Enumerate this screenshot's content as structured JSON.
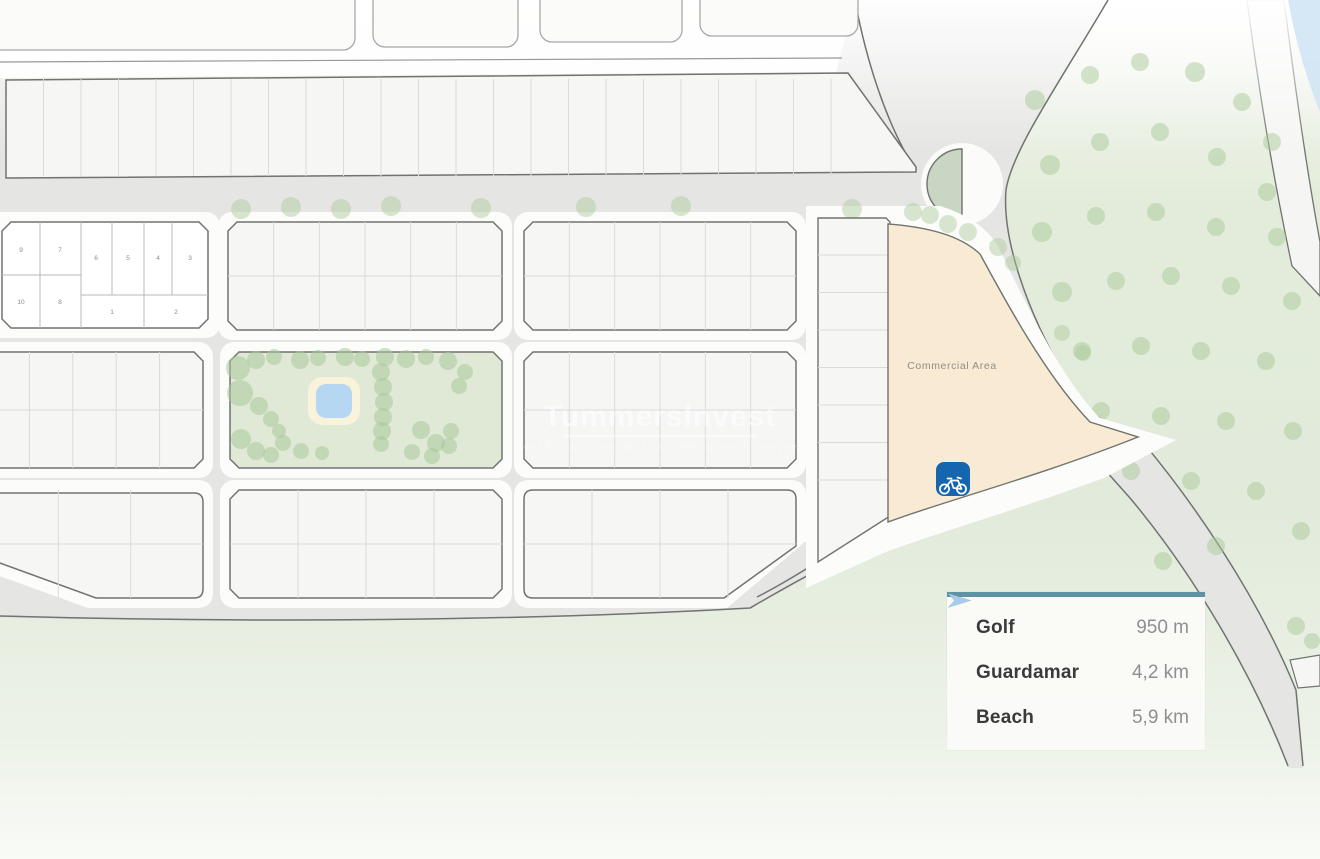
{
  "map": {
    "watermark_title": "TummersInvest",
    "watermark_tagline": "Real Estate - Inmobiliaria - Immobilien - Vastgoed",
    "commercial_area_label": "Commercial Area",
    "plot_numbers": [
      "9",
      "7",
      "6",
      "5",
      "4",
      "3",
      "10",
      "8",
      "1",
      "2"
    ],
    "colors": {
      "street_gray": "#e5e6e4",
      "block_white": "#f6f6f5",
      "sidewalk_white": "#fcfcfb",
      "green_area": "#e3ecda",
      "park_green": "#dfe9d6",
      "tree_green": "#aac99a",
      "commercial_cream": "#f9ead3",
      "pool_blue": "#b5d7f2",
      "water_blue": "#cfe3f4",
      "bike_marker_blue": "#1665af",
      "road_outline": "#70736f"
    }
  },
  "legend": {
    "accent_bar_color": "#5e93a5",
    "rows": [
      {
        "label": "Golf",
        "value": "950 m",
        "arrow_color": "#29b577"
      },
      {
        "label": "Guardamar",
        "value": "4,2 km",
        "arrow_color": "#c4861a"
      },
      {
        "label": "Beach",
        "value": "5,9 km",
        "arrow_color": "#a6cbee"
      }
    ]
  }
}
